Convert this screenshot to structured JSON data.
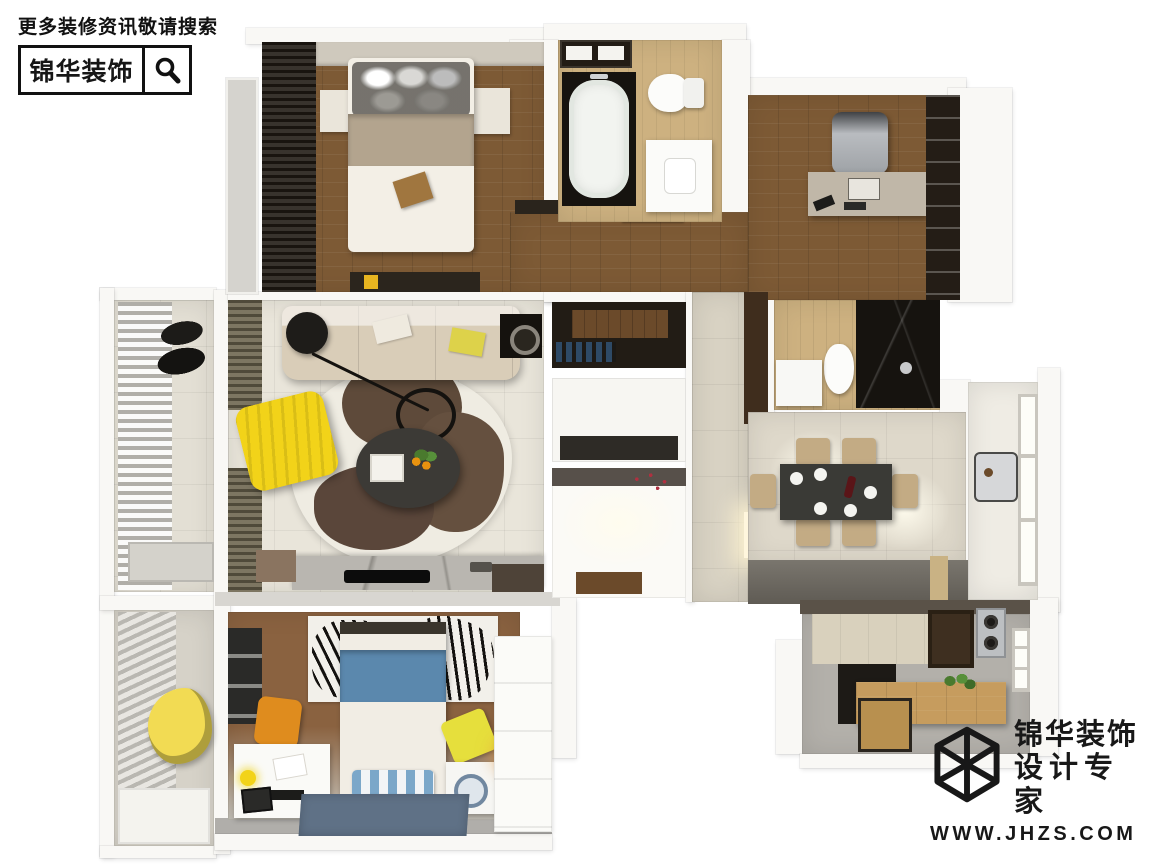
{
  "watermark": {
    "line1": "更多装修资讯敬请搜索",
    "brand": "锦华装饰",
    "icon": "magnifier-icon"
  },
  "logo": {
    "brand_line1": "锦华装饰",
    "brand_line2": "设计专家",
    "website": "WWW.JHZS.COM",
    "icon": "cube-wireframe-icon"
  },
  "palette": {
    "ink": "#161616",
    "wall": "#f9f8f5",
    "wall_shadow": "#d8d6d1",
    "wood_dark": "#6e4e2d",
    "wood": "#7d5a35",
    "wood_warm": "#8a6240",
    "wood_light": "#cdb180",
    "wood_counter": "#c69c5e",
    "tile_beige": "#d8d2c3",
    "tile_light": "#e9e5da",
    "tile_dining": "#ded8ca",
    "dark": "#221c15",
    "marble_dark": "#16130f",
    "marble_gray": "#b9b6b0",
    "steel": "#bcbfc2",
    "cream": "#f1ede4",
    "beige": "#b3a48e",
    "accent_yellow": "#f2d319",
    "accent_orange": "#df8c1e",
    "accent_blue": "#5b88ad",
    "rug_blue": "#5f7186",
    "olive": "#6e6750",
    "glow": "#fff6dd"
  }
}
